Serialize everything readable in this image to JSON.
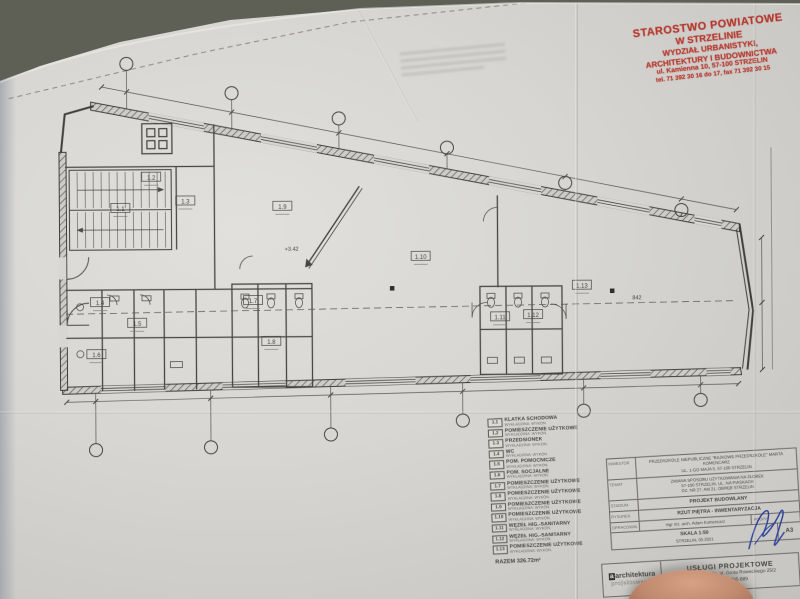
{
  "colors": {
    "stamp_red": "#b5352b",
    "ink": "#45443f",
    "signature_blue": "#2b3f9e",
    "paper": "#d7d6d2",
    "desk": "#5f6156"
  },
  "stamp": {
    "lines": [
      "STAROSTWO POWIATOWE",
      "W STRZELINIE",
      "WYDZIAŁ URBANISTYKI,",
      "ARCHITEKTURY I BUDOWNICTWA",
      "ul. Kamienna 10, 57-100 STRZELIN",
      "tel. 71 392 30 16 do 17, fax 71 392 30 15"
    ]
  },
  "plan": {
    "room_tags": [
      "1.1",
      "1.2",
      "1.3",
      "1.4",
      "1.5",
      "1.6",
      "1.7",
      "1.8",
      "1.9",
      "1.10",
      "1.11",
      "1.12",
      "1.13"
    ],
    "level_mark": "+3.42",
    "dim_label": "842"
  },
  "legend": {
    "rows": [
      {
        "no": "1.1",
        "name": "KLATKA SCHODOWA",
        "sub": "WYKŁADZINA: WYKON."
      },
      {
        "no": "1.2",
        "name": "POMIESZCZENIE UŻYTKOWE",
        "sub": "WYKŁADZINA: WYKON."
      },
      {
        "no": "1.3",
        "name": "PRZEDSIONEK",
        "sub": "WYKŁADZINA: WYKON."
      },
      {
        "no": "1.4",
        "name": "WC",
        "sub": "WYKŁADZINA: WYKON."
      },
      {
        "no": "1.5",
        "name": "POM. POMOCNICZE",
        "sub": "WYKŁADZINA: WYKON."
      },
      {
        "no": "1.6",
        "name": "POM. SOCJALNE",
        "sub": "WYKŁADZINA: WYKON."
      },
      {
        "no": "1.7",
        "name": "POMIESZCZENIE UŻYTKOWE",
        "sub": "WYKŁADZINA: WYKON."
      },
      {
        "no": "1.8",
        "name": "POMIESZCZENIE UŻYTKOWE",
        "sub": "WYKŁADZINA: WYKON."
      },
      {
        "no": "1.9",
        "name": "POMIESZCZENIE UŻYTKOWE",
        "sub": "WYKŁADZINA: WYKON."
      },
      {
        "no": "1.10",
        "name": "POMIESZCZENIE UŻYTKOWE",
        "sub": "WYKŁADZINA: WYKON."
      },
      {
        "no": "1.11",
        "name": "WĘZEŁ HIG.-SANITARNY",
        "sub": "WYKŁADZINA: WYKON."
      },
      {
        "no": "1.12",
        "name": "WĘZEŁ HIG.-SANITARNY",
        "sub": "WYKŁADZINA: WYKON."
      },
      {
        "no": "1.13",
        "name": "POMIESZCZENIE UŻYTKOWE",
        "sub": "WYKŁADZINA: WYKON."
      }
    ],
    "total": "RAZEM 326.72m²"
  },
  "title_block": {
    "investor_label": "INWESTOR",
    "investor_line1": "PRZEDSZKOLE NIEPUBLICZNE \"BAJKOWE PRZEDSZKOLE\" MARTA KOMENCARZ",
    "investor_line2": "UL. 1-GO MAJA 5, 57-100 STRZELIN",
    "temat_label": "TEMAT",
    "temat_line1": "ZMIANA SPOSOBU UŻYTKOWANIA NA ŻŁOBEK",
    "temat_line2": "57-100 STRZELIN, UL. NA PIASKACH",
    "temat_line3": "DZ. NR 27, AM 21, OBRĘB STRZELIN",
    "stadium_label": "STADIUM",
    "stadium_value": "PROJEKT BUDOWLANY",
    "rysunek_label": "RYSUNEK",
    "rysunek_value": "RZUT PIĘTRA - INWENTARYZACJA",
    "oprac_label": "OPRACOWAŁ",
    "oprac_value": "mgr inż. arch. Adam Komencarz",
    "podpis_label": "PODPIS",
    "skala_text": "SKALA 1:50",
    "miejsce_data": "STRZELIN, 05.2021",
    "format": "A3"
  },
  "branding": {
    "logo_line1": "architektura",
    "logo_line2": "projektowanie",
    "office_line1": "USŁUGI PROJEKTOWE",
    "office_line2": "57-100 Strzelin, ul. Grota Roweckiego 25/2",
    "office_line3": "tel. 608 795 889"
  }
}
